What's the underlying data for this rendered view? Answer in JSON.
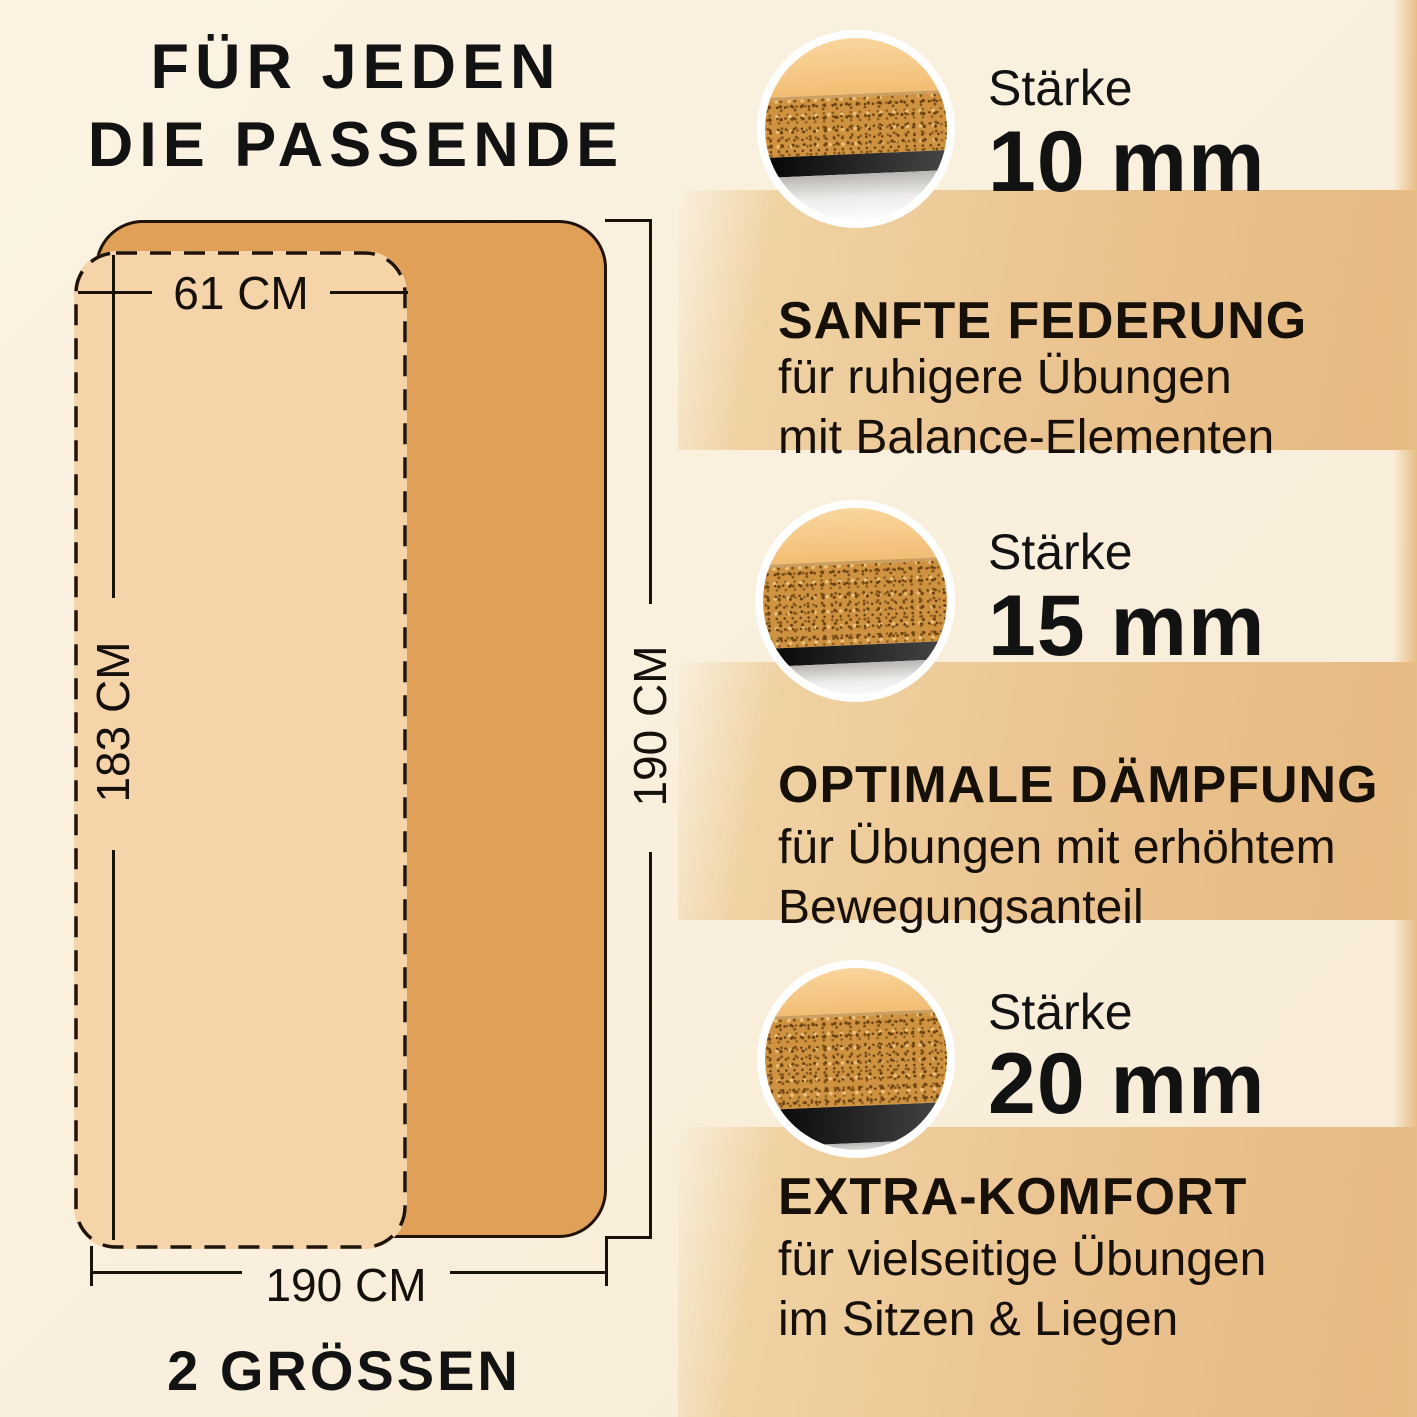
{
  "title": {
    "line1": "FÜR JEDEN",
    "line2": "DIE PASSENDE"
  },
  "diagram": {
    "small_mat": {
      "width_label": "61 CM",
      "height_label": "183 CM"
    },
    "large_mat": {
      "height_label": "190 CM",
      "width_label": "190 CM"
    },
    "caption": "2 GRÖSSEN"
  },
  "options": [
    {
      "thickness_label": "Stärke",
      "thickness_value": "10 mm",
      "heading": "SANFTE FEDERUNG",
      "description_line1": "für ruhigere Übungen",
      "description_line2": "mit Balance-Elementen"
    },
    {
      "thickness_label": "Stärke",
      "thickness_value": "15 mm",
      "heading": "OPTIMALE DÄMPFUNG",
      "description_line1": "für Übungen mit erhöhtem",
      "description_line2": "Bewegungsanteil"
    },
    {
      "thickness_label": "Stärke",
      "thickness_value": "20 mm",
      "heading": "EXTRA-KOMFORT",
      "description_line1": "für vielseitige Übungen",
      "description_line2": "im Sitzen & Liegen"
    }
  ],
  "colors": {
    "background_cream": "#f9efdc",
    "band_tan": "#eac28e",
    "mat_large_orange": "#e0a058",
    "mat_small_light": "#f5d4aa",
    "cork": "#cf9240",
    "text_black": "#121212"
  }
}
